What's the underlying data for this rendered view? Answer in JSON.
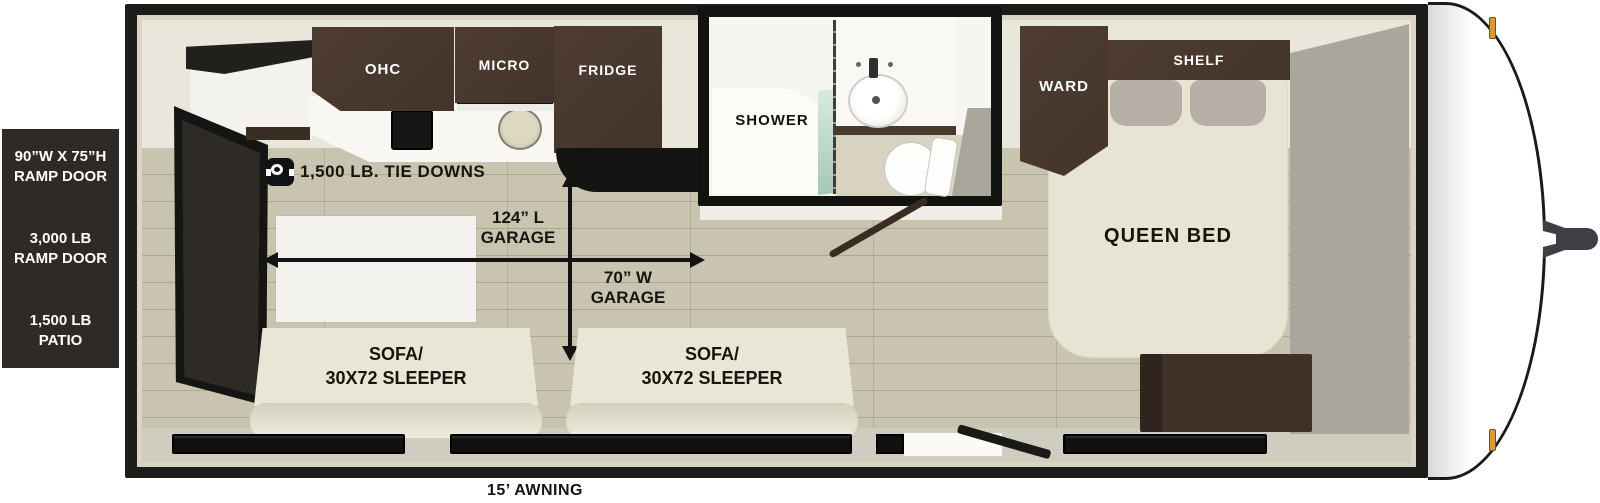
{
  "title": "travel trailer floorplan",
  "colors": {
    "cabinet_wood": "#4a392e",
    "floor_wood": "#c8c4b0",
    "sofa_cream": "#e9e6d5",
    "panel_dark": "#2d2a27",
    "marker_light_amber": "#dd9a33"
  },
  "left_panel": {
    "ramp_size_line1": "90”W X 75”H",
    "ramp_size_line2": "RAMP DOOR",
    "ramp_weight_line1": "3,000 LB",
    "ramp_weight_line2": "RAMP DOOR",
    "patio_line1": "1,500 LB",
    "patio_line2": "PATIO"
  },
  "kitchen": {
    "ohc": "OHC",
    "micro": "MICRO",
    "fridge": "FRIDGE"
  },
  "bathroom": {
    "shower": "SHOWER"
  },
  "bedroom": {
    "ward": "WARD",
    "shelf": "SHELF",
    "queen_bed": "QUEEN BED"
  },
  "garage": {
    "tie_downs": "1,500 LB. TIE DOWNS",
    "length_line1": "124” L",
    "length_line2": "GARAGE",
    "width_line1": "70” W",
    "width_line2": "GARAGE"
  },
  "sofas": [
    {
      "line1": "SOFA/",
      "line2": "30X72 SLEEPER"
    },
    {
      "line1": "SOFA/",
      "line2": "30X72 SLEEPER"
    }
  ],
  "awning": "15’ AWNING"
}
